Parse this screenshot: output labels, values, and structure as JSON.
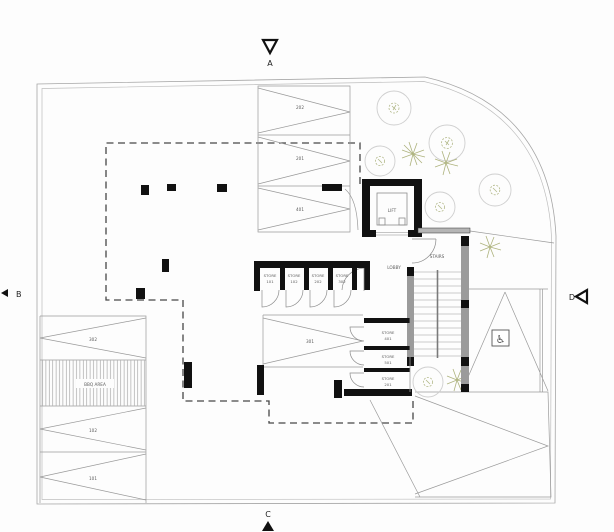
{
  "plan": {
    "markers": {
      "top": "A",
      "left": "B",
      "bottom": "C",
      "right": "D"
    },
    "labels": {
      "lift": "LIFT",
      "lobby": "LOBBY",
      "stairs": "STAIRS",
      "bbq_area": "BBQ AREA"
    },
    "stores_row": [
      {
        "title": "STORE",
        "number": "101"
      },
      {
        "title": "STORE",
        "number": "102"
      },
      {
        "title": "STORE",
        "number": "202"
      },
      {
        "title": "STORE",
        "number": "302"
      }
    ],
    "stores_col": [
      {
        "title": "STORE",
        "number": "401"
      },
      {
        "title": "STORE",
        "number": "501"
      },
      {
        "title": "STORE",
        "number": "201"
      }
    ],
    "parking_top": [
      "202",
      "201",
      "401"
    ],
    "parking_left": [
      "302",
      "102",
      "101"
    ],
    "parking_middle": "301",
    "icons": {
      "disabled_parking": "♿"
    },
    "colors": {
      "wall": "#111111",
      "concrete": "#999999",
      "line": "#8a8a8a",
      "tree_olive": "#b3b98a",
      "dash": "#444444"
    }
  }
}
